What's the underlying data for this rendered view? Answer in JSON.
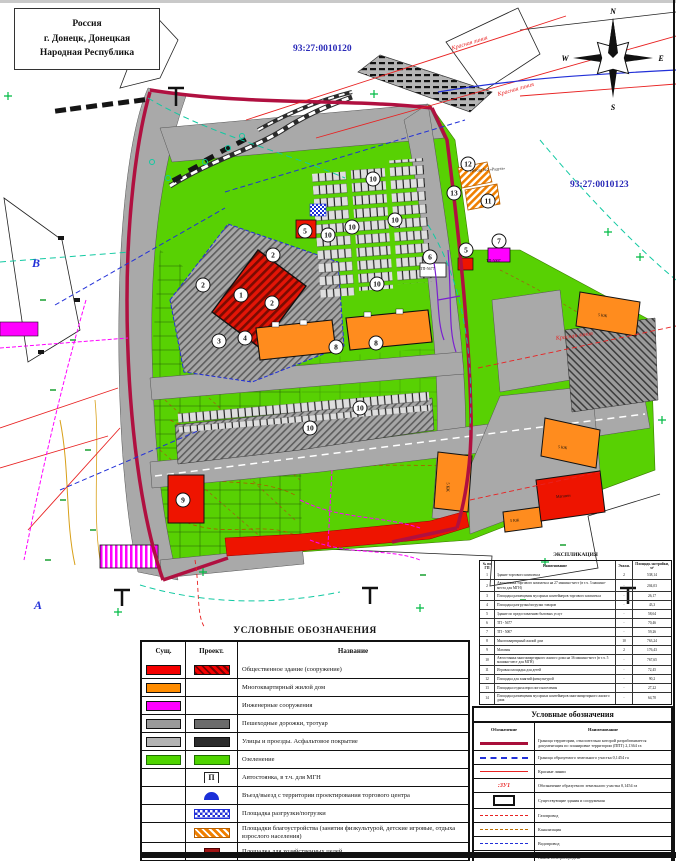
{
  "palette": {
    "green": "#58d103",
    "road_gray": "#a9a9a9",
    "orange": "#ff8c1e",
    "red": "#ee1400",
    "magenta": "#ff00ff",
    "boundary_crimson": "#b01040",
    "red_line": "#e82222",
    "blue": "#2230d8",
    "teal": "#12c9a2",
    "cadastral_blue": "#2a2ab8"
  },
  "sheet": {
    "title_box": [
      "Россия",
      "г. Донецк, Донецкая",
      "Народная Республика"
    ],
    "cadastral_labels": [
      {
        "text": "93:27:0010120",
        "x": 293,
        "y": 44
      },
      {
        "text": "93:27:0010123",
        "x": 570,
        "y": 180
      }
    ],
    "compass": {
      "n": "N",
      "w": "W",
      "e": "E",
      "s": "S"
    }
  },
  "map": {
    "street_labels": [
      {
        "text": "Красная линия",
        "x": 452,
        "y": 46,
        "rot": -17
      },
      {
        "text": "Красная линия",
        "x": 498,
        "y": 92,
        "rot": -16
      },
      {
        "text": "Красная линия",
        "x": 556,
        "y": 336,
        "rot": -8
      }
    ],
    "area_letters": [
      {
        "text": "В",
        "x": 32,
        "y": 256
      },
      {
        "text": "А",
        "x": 34,
        "y": 598
      }
    ],
    "building_labels": [
      {
        "text": "Детсад №2 «Радуга»",
        "x": 470,
        "y": 168,
        "rot": -4
      },
      {
        "text": "ТП-5677",
        "x": 420,
        "y": 266,
        "rot": 0
      },
      {
        "text": "ТП-5007",
        "x": 486,
        "y": 258,
        "rot": 0
      },
      {
        "text": "5 КЖ",
        "x": 598,
        "y": 312,
        "rot": 8
      },
      {
        "text": "5 КЖ",
        "x": 558,
        "y": 444,
        "rot": 8
      },
      {
        "text": "5 КЖ",
        "x": 448,
        "y": 480,
        "rot": 90
      },
      {
        "text": "5 КЖ",
        "x": 510,
        "y": 518,
        "rot": -4
      },
      {
        "text": "Магазин",
        "x": 556,
        "y": 494,
        "rot": -6
      }
    ],
    "markers": [
      {
        "n": "1",
        "x": 241,
        "y": 295
      },
      {
        "n": "2",
        "x": 273,
        "y": 255
      },
      {
        "n": "2",
        "x": 203,
        "y": 285
      },
      {
        "n": "2",
        "x": 272,
        "y": 303
      },
      {
        "n": "3",
        "x": 219,
        "y": 341
      },
      {
        "n": "4",
        "x": 245,
        "y": 338
      },
      {
        "n": "5",
        "x": 305,
        "y": 231
      },
      {
        "n": "5",
        "x": 466,
        "y": 250
      },
      {
        "n": "6",
        "x": 430,
        "y": 257
      },
      {
        "n": "7",
        "x": 499,
        "y": 241
      },
      {
        "n": "8",
        "x": 336,
        "y": 347
      },
      {
        "n": "8",
        "x": 376,
        "y": 343
      },
      {
        "n": "9",
        "x": 183,
        "y": 500
      },
      {
        "n": "10",
        "x": 373,
        "y": 179
      },
      {
        "n": "10",
        "x": 328,
        "y": 235
      },
      {
        "n": "10",
        "x": 352,
        "y": 227
      },
      {
        "n": "10",
        "x": 395,
        "y": 220
      },
      {
        "n": "10",
        "x": 377,
        "y": 284
      },
      {
        "n": "10",
        "x": 360,
        "y": 408
      },
      {
        "n": "10",
        "x": 310,
        "y": 428
      },
      {
        "n": "11",
        "x": 488,
        "y": 201
      },
      {
        "n": "12",
        "x": 468,
        "y": 164
      },
      {
        "n": "13",
        "x": 454,
        "y": 193
      }
    ]
  },
  "legend_left": {
    "title": "УСЛОВНЫЕ ОБОЗНАЧЕНИЯ",
    "headers": [
      "Сущ.",
      "Проект.",
      "Название"
    ],
    "rows": [
      {
        "s": "red",
        "p": "red-hatch",
        "name": "Общественное здание (сооружение)"
      },
      {
        "s": "orange",
        "p": "none",
        "name": "Многоквартирный жилой дом"
      },
      {
        "s": "magenta",
        "p": "none",
        "name": "Инженерные сооружения"
      },
      {
        "s": "gray",
        "p": "darkgray",
        "name": "Пешеходные дорожки, тротуар"
      },
      {
        "s": "lightgray",
        "p": "asphalt",
        "name": "Улицы и проезды. Асфальтовое покрытие"
      },
      {
        "s": "green",
        "p": "green",
        "name": "Озеленение"
      },
      {
        "s": "none",
        "p": "parking",
        "name": "Автостоянка, в т.ч. для МГН",
        "icon_text": "П"
      },
      {
        "s": "none",
        "p": "entry",
        "name": "Въезд/выезд с территории проектирования торгового центра"
      },
      {
        "s": "none",
        "p": "bluecheck",
        "name": "Площадка разгрузки/погрузки"
      },
      {
        "s": "none",
        "p": "orangehatch",
        "name": "Площадки благоустройства (занятия физкультурой, детские игровые, отдыха взрослого населения)"
      },
      {
        "s": "none",
        "p": "hoz",
        "name": "Площадка для хозяйственных целей"
      }
    ]
  },
  "explication": {
    "title": "ЭКСПЛИКАЦИЯ",
    "headers": [
      "№ по ГП",
      "Наименование",
      "Этажн.",
      "Площадь застройки, м²"
    ],
    "rows": [
      {
        "num": "1",
        "name": "Здание торгового комплекса",
        "floors": "2",
        "area": "538,14"
      },
      {
        "num": "2",
        "name": "Автостоянка торгового комплекса на 27 машино-мест (в т.ч. 3 машино-места для МГН)",
        "floors": "-",
        "area": "204,03"
      },
      {
        "num": "3",
        "name": "Площадка размещения мусорных контейнеров торгового комплекса",
        "floors": "-",
        "area": "26,17"
      },
      {
        "num": "4",
        "name": "Площадка разгрузки/погрузки товаров",
        "floors": "-",
        "area": "43,3"
      },
      {
        "num": "5",
        "name": "Здание по предоставлению бытовых услуг",
        "floors": "-",
        "area": "58,64"
      },
      {
        "num": "6",
        "name": "ТП - 5677",
        "floors": "-",
        "area": "70,46"
      },
      {
        "num": "7",
        "name": "ТП - 5007",
        "floors": "-",
        "area": "59,26"
      },
      {
        "num": "8",
        "name": "Многоквартирный жилой дом",
        "floors": "10",
        "area": "763,24"
      },
      {
        "num": "9",
        "name": "Магазин",
        "floors": "2",
        "area": "176,43"
      },
      {
        "num": "10",
        "name": "Автостоянка многоквартирного жилого дома на 36 машино-мест (в т.ч. 5 машино-мест для МГН)",
        "floors": "-",
        "area": "767,65"
      },
      {
        "num": "11",
        "name": "Игровая площадка для детей",
        "floors": "-",
        "area": "72,45"
      },
      {
        "num": "12",
        "name": "Площадка для занятий физкультурой",
        "floors": "-",
        "area": "90,2"
      },
      {
        "num": "13",
        "name": "Площадка отдыха взрослого населения",
        "floors": "-",
        "area": "27,22"
      },
      {
        "num": "14",
        "name": "Площадка размещения мусорных контейнеров многоквартирного жилого дома",
        "floors": "-",
        "area": "64,70"
      }
    ]
  },
  "legend_right": {
    "title": "Условные обозначения",
    "headers": [
      "Обозначение",
      "Наименование"
    ],
    "rows": [
      {
        "sym": "ppt-line",
        "name": "Граница территории, относительно которой разрабатывается документация по планировке территории (ППТ) 2,1364 га"
      },
      {
        "sym": "parcel-line",
        "name": "Граница образуемого земельного участка 0,1454 га"
      },
      {
        "sym": "red-line",
        "name": "Красные линии"
      },
      {
        "sym": "zu-label",
        "label": ":ЗУ1",
        "name": "Обозначение образуемого земельного участка 0,1454 га"
      },
      {
        "sym": "exist-bld",
        "name": "Существующие здания и сооружения"
      },
      {
        "sym": "gas",
        "name": "Газопровод"
      },
      {
        "sym": "sewer",
        "name": "Канализация"
      },
      {
        "sym": "water",
        "name": "Водопровод"
      },
      {
        "sym": "power",
        "name": "Линия электропередачи"
      },
      {
        "sym": "cad-num",
        "label": "93:27:0010123",
        "name": "Кадастровый номер объекта недвижимости"
      }
    ]
  }
}
